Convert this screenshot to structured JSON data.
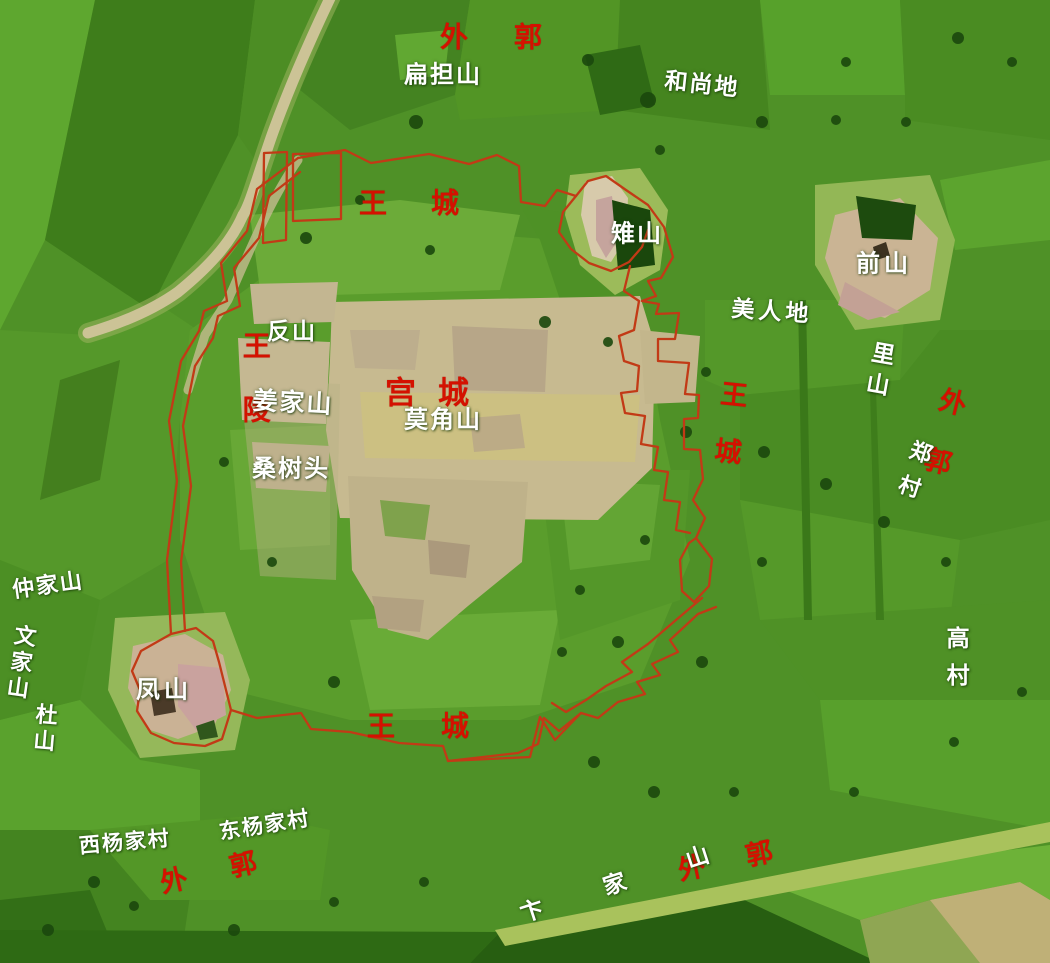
{
  "map_type": "terrain-relief-map",
  "colors": {
    "label_red": "#d41100",
    "label_white": "#ffffff",
    "wall_line": "#c23a16",
    "terrain_base_green": "#4f9127",
    "platform_tan": "#c7ba90"
  },
  "labels": [
    {
      "id": "outer-wall-north",
      "text": "外郭",
      "color": "red",
      "x": 514,
      "y": 37,
      "size": 28,
      "rot": 0,
      "vertical": false,
      "gap": 46
    },
    {
      "id": "royal-city-north",
      "text": "王城",
      "color": "red",
      "x": 431,
      "y": 203,
      "size": 28,
      "rot": 0,
      "vertical": false,
      "gap": 44
    },
    {
      "id": "royal-tomb-west",
      "text": "王陵",
      "color": "red",
      "x": 255,
      "y": 395,
      "size": 28,
      "rot": 0,
      "vertical": true,
      "gap": 36
    },
    {
      "id": "palace-city",
      "text": "宫城",
      "color": "red",
      "x": 438,
      "y": 394,
      "size": 31,
      "rot": 0,
      "vertical": false,
      "gap": 22
    },
    {
      "id": "royal-city-east",
      "text": "王城",
      "color": "red",
      "x": 727,
      "y": 437,
      "size": 27,
      "rot": 6,
      "vertical": true,
      "gap": 30
    },
    {
      "id": "outer-wall-east",
      "text": "外郭",
      "color": "red",
      "x": 939,
      "y": 447,
      "size": 27,
      "rot": 14,
      "vertical": true,
      "gap": 34
    },
    {
      "id": "royal-city-south",
      "text": "王城",
      "color": "red",
      "x": 441,
      "y": 726,
      "size": 28,
      "rot": 0,
      "vertical": false,
      "gap": 46
    },
    {
      "id": "outer-wall-southwest",
      "text": "外郭",
      "color": "red",
      "x": 230,
      "y": 868,
      "size": 27,
      "rot": -13,
      "vertical": false,
      "gap": 44
    },
    {
      "id": "outer-wall-southeast",
      "text": "外郭",
      "color": "red",
      "x": 746,
      "y": 857,
      "size": 27,
      "rot": -12,
      "vertical": false,
      "gap": 42
    },
    {
      "id": "biandan-shan",
      "text": "扁担山",
      "color": "white",
      "x": 443,
      "y": 75,
      "size": 24,
      "rot": 0,
      "vertical": false,
      "gap": 2
    },
    {
      "id": "heshang-di",
      "text": "和尚地",
      "color": "white",
      "x": 702,
      "y": 84,
      "size": 23,
      "rot": 6,
      "vertical": false,
      "gap": 2
    },
    {
      "id": "zhi-shan",
      "text": "雉山",
      "color": "white",
      "x": 637,
      "y": 234,
      "size": 24,
      "rot": 0,
      "vertical": false,
      "gap": 2
    },
    {
      "id": "qian-shan",
      "text": "前山",
      "color": "white",
      "x": 884,
      "y": 264,
      "size": 24,
      "rot": 0,
      "vertical": false,
      "gap": 4
    },
    {
      "id": "meiren-di",
      "text": "美人地",
      "color": "white",
      "x": 772,
      "y": 311,
      "size": 23,
      "rot": 4,
      "vertical": false,
      "gap": 4
    },
    {
      "id": "li-shan",
      "text": "里山",
      "color": "white",
      "x": 878,
      "y": 372,
      "size": 23,
      "rot": 10,
      "vertical": true,
      "gap": 8
    },
    {
      "id": "zheng-cun",
      "text": "郑村",
      "color": "white",
      "x": 912,
      "y": 475,
      "size": 22,
      "rot": 18,
      "vertical": true,
      "gap": 14
    },
    {
      "id": "fan-shan",
      "text": "反山",
      "color": "white",
      "x": 292,
      "y": 331,
      "size": 23,
      "rot": 0,
      "vertical": false,
      "gap": 2
    },
    {
      "id": "jiangjia-shan",
      "text": "姜家山",
      "color": "white",
      "x": 293,
      "y": 403,
      "size": 25,
      "rot": 3,
      "vertical": false,
      "gap": 2
    },
    {
      "id": "mojiao-shan",
      "text": "莫角山",
      "color": "white",
      "x": 443,
      "y": 420,
      "size": 24,
      "rot": 0,
      "vertical": false,
      "gap": 2
    },
    {
      "id": "sangshu-tou",
      "text": "桑树头",
      "color": "white",
      "x": 291,
      "y": 469,
      "size": 24,
      "rot": 0,
      "vertical": false,
      "gap": 2
    },
    {
      "id": "zhongjia-shan",
      "text": "仲家山",
      "color": "white",
      "x": 48,
      "y": 585,
      "size": 22,
      "rot": -8,
      "vertical": false,
      "gap": 2
    },
    {
      "id": "wenjia-shan",
      "text": "文家山",
      "color": "white",
      "x": 20,
      "y": 663,
      "size": 22,
      "rot": 8,
      "vertical": true,
      "gap": 4
    },
    {
      "id": "du-shan",
      "text": "杜山",
      "color": "white",
      "x": 44,
      "y": 729,
      "size": 22,
      "rot": 5,
      "vertical": true,
      "gap": 4
    },
    {
      "id": "feng-shan",
      "text": "凤山",
      "color": "white",
      "x": 164,
      "y": 690,
      "size": 24,
      "rot": 0,
      "vertical": false,
      "gap": 4
    },
    {
      "id": "gao-cun",
      "text": "高村",
      "color": "white",
      "x": 956,
      "y": 663,
      "size": 23,
      "rot": 0,
      "vertical": true,
      "gap": 14
    },
    {
      "id": "xiyangjia-cun",
      "text": "西杨家村",
      "color": "white",
      "x": 125,
      "y": 843,
      "size": 21,
      "rot": -5,
      "vertical": false,
      "gap": 2
    },
    {
      "id": "dongyangjia-cun",
      "text": "东杨家村",
      "color": "white",
      "x": 265,
      "y": 826,
      "size": 21,
      "rot": -9,
      "vertical": false,
      "gap": 2
    },
    {
      "id": "bianjia-shan",
      "text": "卞家山",
      "color": "white",
      "x": 645,
      "y": 874,
      "size": 23,
      "rot": -18,
      "vertical": false,
      "gap": 64
    }
  ]
}
